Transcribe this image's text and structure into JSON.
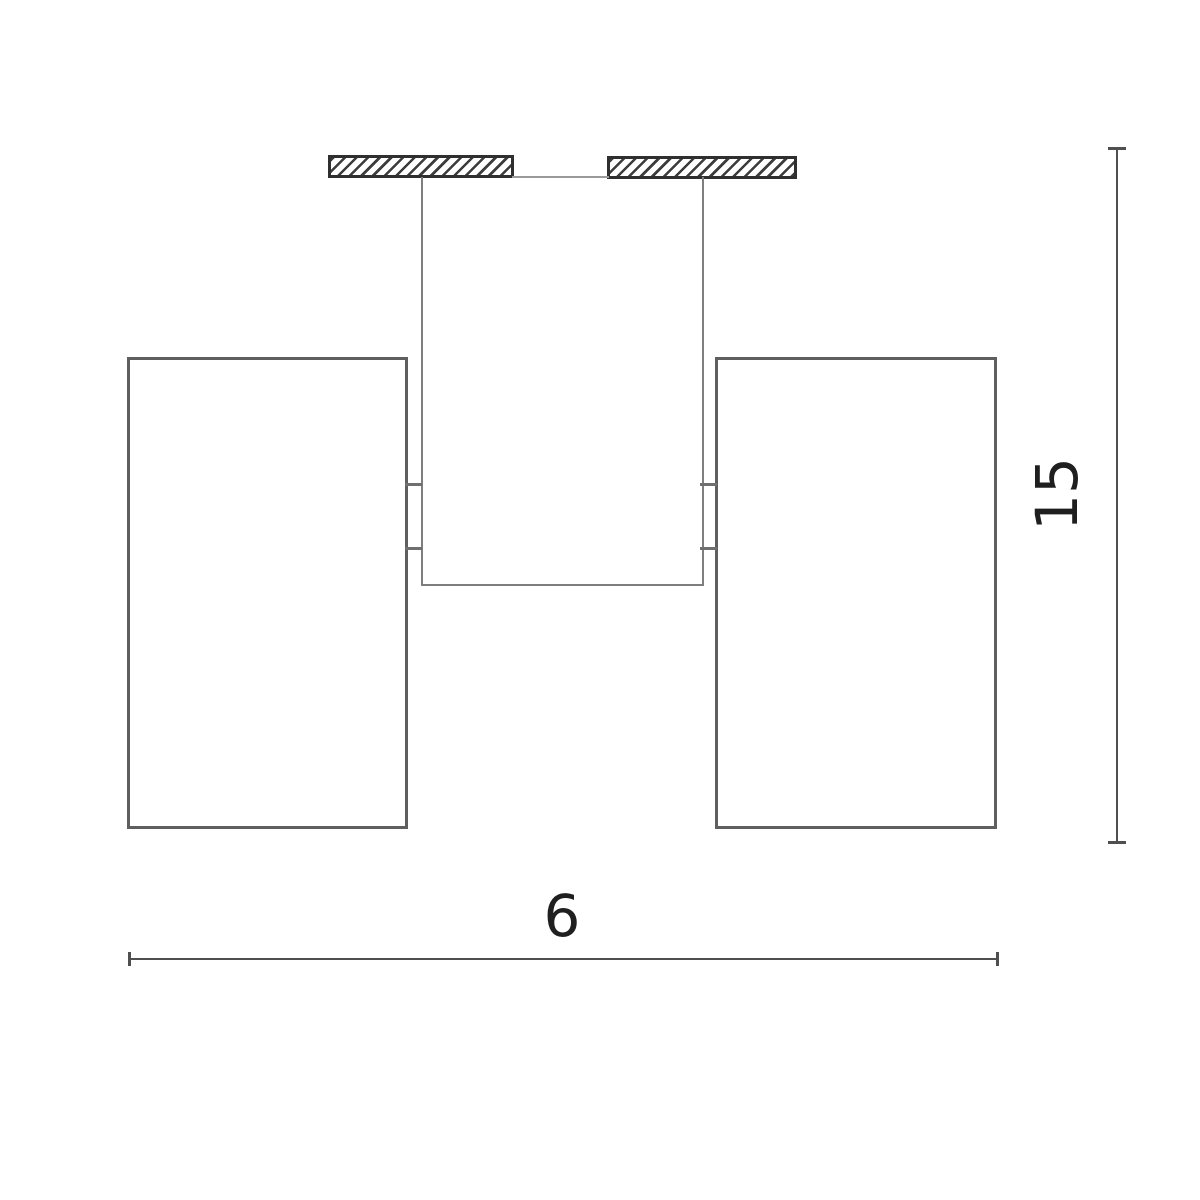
{
  "drawing": {
    "type": "technical-dimension-drawing",
    "subject": "ceiling-mounted-double-spotlight-front-view",
    "dimensions": {
      "width_label": "6",
      "height_label": "15"
    },
    "parts": [
      "ceiling-mount-plate-left",
      "ceiling-mount-plate-right",
      "fixture-body",
      "lamp-shade-left",
      "lamp-shade-right",
      "shade-connector-left",
      "shade-connector-right"
    ],
    "colors": {
      "background": "#ffffff",
      "plate_border": "#2f2f2f",
      "hatch": "#3c3c3c",
      "shade_line": "#5f5f5f",
      "body_line": "#7e7e7e",
      "ceiling_line": "#9a9a9a",
      "connector_line": "#6f6f6f",
      "dimension_line": "#4f4f4f",
      "label": "#1f1f1f"
    }
  }
}
